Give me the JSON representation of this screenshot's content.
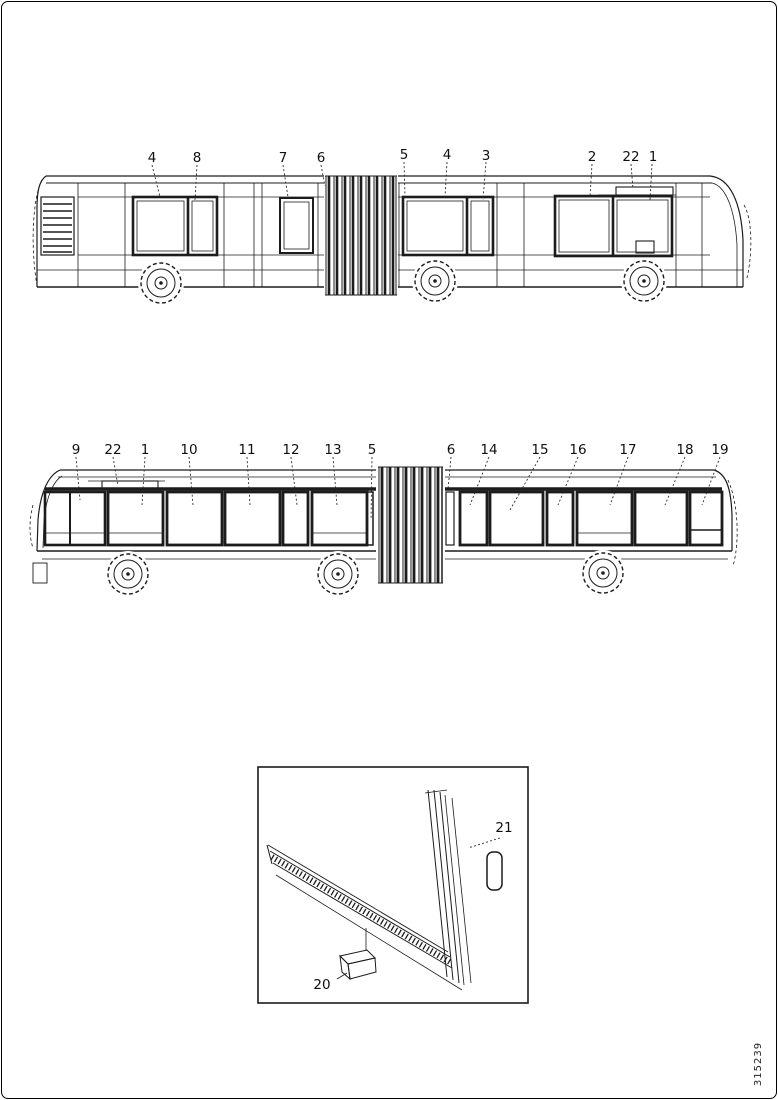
{
  "page": {
    "background": "#ffffff",
    "line_color": "#1c1c1c",
    "drawing_number": "315239"
  },
  "top_view": {
    "description": "Articulated bus, right side elevation with numbered glazing parts",
    "callouts": [
      {
        "id": "4a",
        "label": "4"
      },
      {
        "id": "8",
        "label": "8"
      },
      {
        "id": "7",
        "label": "7"
      },
      {
        "id": "6a",
        "label": "6"
      },
      {
        "id": "5a",
        "label": "5"
      },
      {
        "id": "4b",
        "label": "4"
      },
      {
        "id": "3",
        "label": "3"
      },
      {
        "id": "2",
        "label": "2"
      },
      {
        "id": "22a",
        "label": "22"
      },
      {
        "id": "1a",
        "label": "1"
      }
    ]
  },
  "middle_view": {
    "description": "Articulated bus, left side elevation with numbered glazing parts",
    "callouts": [
      {
        "id": "9",
        "label": "9"
      },
      {
        "id": "22b",
        "label": "22"
      },
      {
        "id": "1b",
        "label": "1"
      },
      {
        "id": "10",
        "label": "10"
      },
      {
        "id": "11",
        "label": "11"
      },
      {
        "id": "12",
        "label": "12"
      },
      {
        "id": "13",
        "label": "13"
      },
      {
        "id": "5b",
        "label": "5"
      },
      {
        "id": "6b",
        "label": "6"
      },
      {
        "id": "14",
        "label": "14"
      },
      {
        "id": "15",
        "label": "15"
      },
      {
        "id": "16",
        "label": "16"
      },
      {
        "id": "17",
        "label": "17"
      },
      {
        "id": "18",
        "label": "18"
      },
      {
        "id": "19",
        "label": "19"
      }
    ]
  },
  "detail_inset": {
    "description": "Window frame lower corner detail",
    "callouts": [
      {
        "id": "20",
        "label": "20"
      },
      {
        "id": "21",
        "label": "21"
      }
    ]
  }
}
